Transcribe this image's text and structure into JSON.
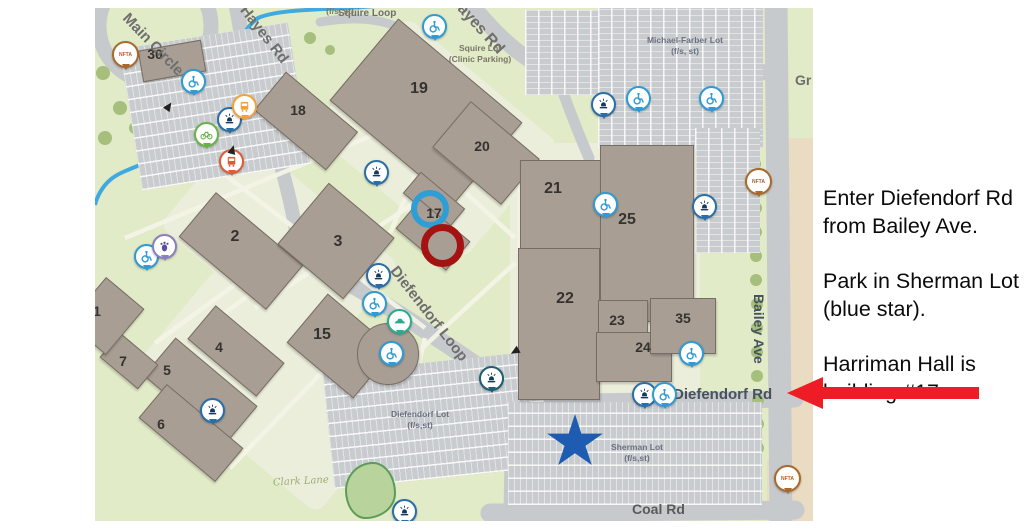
{
  "sidebar": {
    "paragraphs": [
      "Enter Diefendorf Rd from Bailey Ave.",
      "Park in Sherman Lot (blue star).",
      "Harriman Hall is building #17."
    ]
  },
  "map": {
    "building_labels": [
      "30",
      "18",
      "19",
      "20",
      "17",
      "21",
      "22",
      "23",
      "24",
      "25",
      "35",
      "2",
      "3",
      "15",
      "4",
      "5",
      "6",
      "7",
      "1"
    ],
    "roads": {
      "main_circle": "Main Circle",
      "hayes_rd": "Hayes Rd",
      "squire_loop": "Squire Loop",
      "diefendorf_loop": "Diefendorf Loop",
      "diefendorf_rd": "Diefendorf Rd",
      "bailey_ave": "Bailey Ave",
      "coal_rd": "Coal Rd",
      "clark_lane": "Clark Lane",
      "gr_partial": "Gr"
    },
    "lots": {
      "squire": {
        "name": "Squire Lot",
        "sub": "(Clinic Parking)"
      },
      "michael_farber": {
        "name": "Michael-Farber Lot",
        "sub": "(f/s, st)"
      },
      "diefendorf": {
        "name": "Diefendorf Lot",
        "sub": "(f/s,st)"
      },
      "sherman": {
        "name": "Sherman Lot",
        "sub": "(f/s,st)"
      },
      "top_partial": "(f/s, st)"
    },
    "transit": {
      "nfta": "NFTA"
    },
    "icons": {
      "emergency_phone": "blue-light phone pin",
      "accessibility": "wheelchair pin",
      "bus_stop": "bus pin",
      "shuttle": "shuttle pin",
      "bike": "bike rack pin",
      "car_share": "car pin",
      "info_purple": "purple point of interest pin"
    },
    "annotations": {
      "star_color": "#1d5cb0",
      "blue_ring_color": "#2d9fd6",
      "red_ring_color": "#a51212",
      "arrow_color": "#ee1c24"
    }
  }
}
